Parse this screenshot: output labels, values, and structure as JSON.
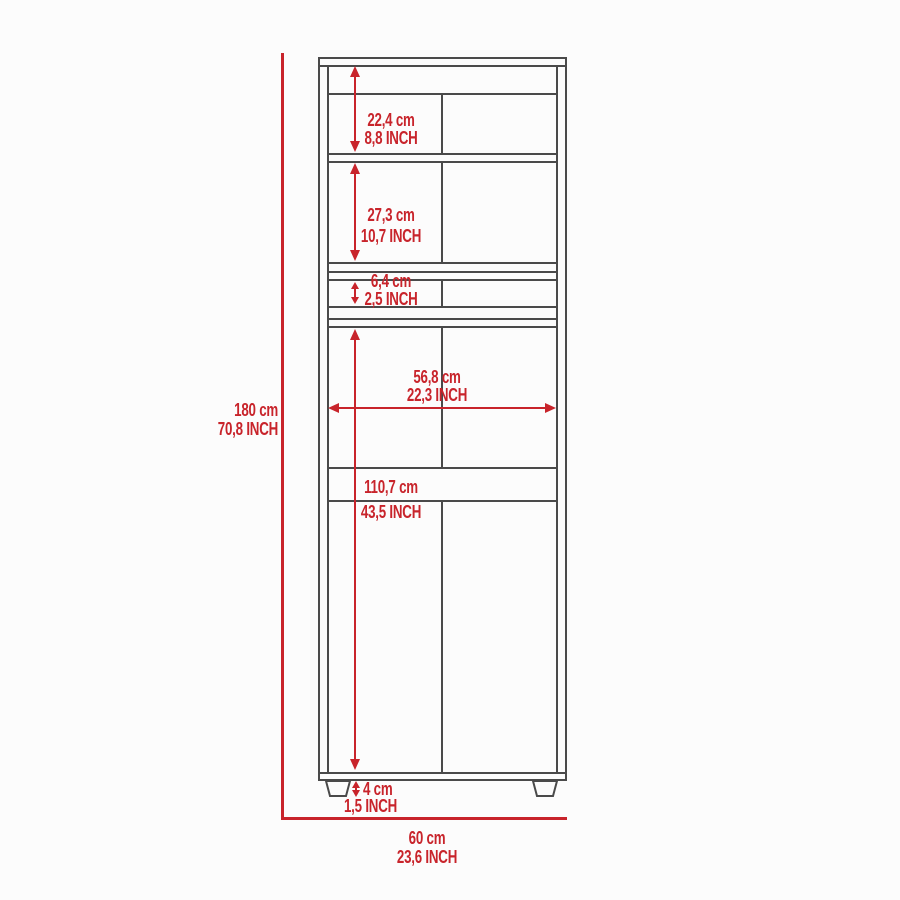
{
  "diagram": {
    "title": "cabinet-front-elevation-dimension-diagram",
    "colors": {
      "accent": "#c8242b",
      "line": "#4a4a4a",
      "background": "#fcfcfc"
    },
    "units": [
      "cm",
      "INCH"
    ],
    "dimensions": {
      "overall_height": {
        "cm": "180 cm",
        "inch": "70,8 INCH"
      },
      "top_compartment": {
        "cm": "22,4 cm",
        "inch": "8,8 INCH"
      },
      "middle_compartment": {
        "cm": "27,3 cm",
        "inch": "10,7 INCH"
      },
      "small_compartment": {
        "cm": "6,4 cm",
        "inch": "2,5 INCH"
      },
      "interior_width": {
        "cm": "56,8 cm",
        "inch": "22,3 INCH"
      },
      "lower_section": {
        "cm": "110,7 cm",
        "inch": "43,5 INCH"
      },
      "foot_height": {
        "cm": "4 cm",
        "inch": "1,5 INCH"
      },
      "overall_width": {
        "cm": "60 cm",
        "inch": "23,6 INCH"
      }
    }
  }
}
